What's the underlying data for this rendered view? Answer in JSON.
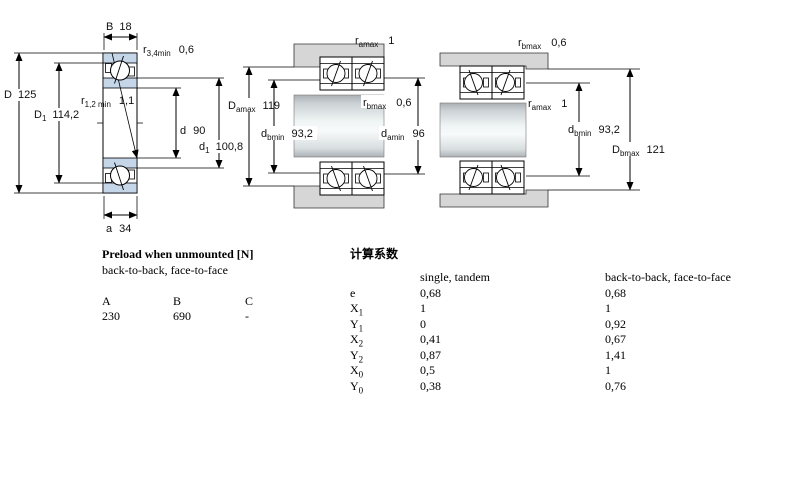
{
  "colors": {
    "ring_blue": "#c5d6e9",
    "housing_gray": "#d6d6d6"
  },
  "diagram_single": {
    "B": {
      "sym": "B",
      "val": "18"
    },
    "r34": {
      "sym": "r",
      "sub": "3,4min",
      "val": "0,6"
    },
    "D": {
      "sym": "D",
      "val": "125"
    },
    "D1": {
      "sym": "D",
      "sub": "1",
      "val": "114,2"
    },
    "r12": {
      "sym": "r",
      "sub": "1,2 min",
      "val": "1,1"
    },
    "d": {
      "sym": "d",
      "val": "90"
    },
    "d1": {
      "sym": "d",
      "sub": "1",
      "val": "100,8"
    },
    "a": {
      "sym": "a",
      "val": "34"
    }
  },
  "diagram_pair_left": {
    "ramax": {
      "sym": "r",
      "sub": "amax",
      "val": "1"
    },
    "Damax": {
      "sym": "D",
      "sub": "amax",
      "val": "119"
    },
    "dbmin": {
      "sym": "d",
      "sub": "bmin",
      "val": "93,2"
    },
    "rbmax": {
      "sym": "r",
      "sub": "bmax",
      "val": "0,6"
    },
    "damin": {
      "sym": "d",
      "sub": "amin",
      "val": "96"
    }
  },
  "diagram_pair_right": {
    "rbmax": {
      "sym": "r",
      "sub": "bmax",
      "val": "0,6"
    },
    "ramax": {
      "sym": "r",
      "sub": "amax",
      "val": "1"
    },
    "dbmin": {
      "sym": "d",
      "sub": "bmin",
      "val": "93,2"
    },
    "Dbmax": {
      "sym": "D",
      "sub": "bmax",
      "val": "121"
    }
  },
  "preload": {
    "title": "Preload when unmounted [N]",
    "subtitle": "back-to-back, face-to-face",
    "headers": [
      "A",
      "B",
      "C"
    ],
    "values": [
      "230",
      "690",
      "-"
    ]
  },
  "factors": {
    "title": "计算系数",
    "col1": "single, tandem",
    "col2": "back-to-back, face-to-face",
    "rows": [
      {
        "sym": "e",
        "sub": "",
        "v1": "0,68",
        "v2": "0,68"
      },
      {
        "sym": "X",
        "sub": "1",
        "v1": "1",
        "v2": "1"
      },
      {
        "sym": "Y",
        "sub": "1",
        "v1": "0",
        "v2": "0,92"
      },
      {
        "sym": "X",
        "sub": "2",
        "v1": "0,41",
        "v2": "0,67"
      },
      {
        "sym": "Y",
        "sub": "2",
        "v1": "0,87",
        "v2": "1,41"
      },
      {
        "sym": "X",
        "sub": "0",
        "v1": "0,5",
        "v2": "1"
      },
      {
        "sym": "Y",
        "sub": "0",
        "v1": "0,38",
        "v2": "0,76"
      }
    ]
  }
}
